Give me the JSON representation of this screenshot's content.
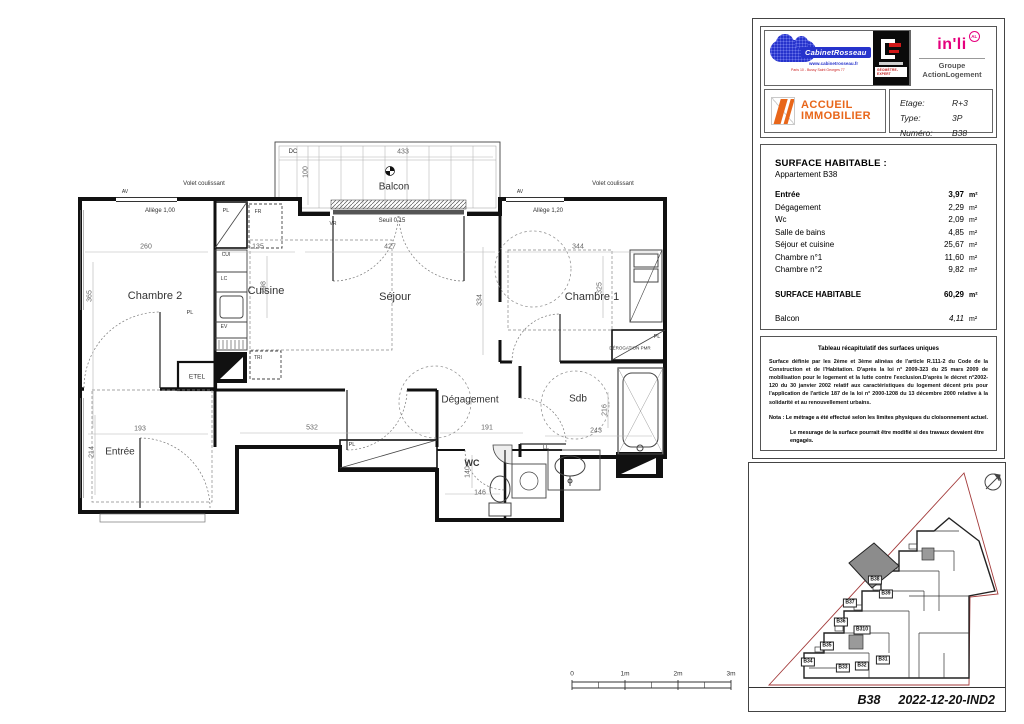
{
  "title_block": {
    "cabinet": {
      "name": "CabinetRosseau",
      "url": "www.cabinetrosseau.fr",
      "address": "Paris 10 - Bussy Saint Georges 77"
    },
    "geometre": {
      "label": "GÉOMÈTRE-EXPERT"
    },
    "inli": {
      "name": "in'li",
      "badge": "AL",
      "group": "Groupe ActionLogement"
    },
    "accueil": {
      "line1": "ACCUEIL",
      "line2": "IMMOBILIER"
    },
    "info": {
      "rows": [
        {
          "label": "Etage:",
          "value": "R+3"
        },
        {
          "label": "Type:",
          "value": "3P"
        },
        {
          "label": "Numéro:",
          "value": "B38"
        }
      ]
    }
  },
  "surface_table": {
    "title": "SURFACE HABITABLE :",
    "subtitle": "Appartement B38",
    "rows": [
      {
        "label": "Entrée",
        "value": "3,97",
        "unit": "m²"
      },
      {
        "label": "Dégagement",
        "value": "2,29",
        "unit": "m²"
      },
      {
        "label": "Wc",
        "value": "2,09",
        "unit": "m²"
      },
      {
        "label": "Salle de bains",
        "value": "4,85",
        "unit": "m²"
      },
      {
        "label": "Séjour et cuisine",
        "value": "25,67",
        "unit": "m²"
      },
      {
        "label": "Chambre n°1",
        "value": "11,60",
        "unit": "m²"
      },
      {
        "label": "Chambre n°2",
        "value": "9,82",
        "unit": "m²"
      }
    ],
    "total": {
      "label": "SURFACE HABITABLE",
      "value": "60,29",
      "unit": "m²"
    },
    "balcon": {
      "label": "Balcon",
      "value": "4,11",
      "unit": "m²"
    }
  },
  "notes": {
    "title": "Tableau récapitulatif des surfaces uniques",
    "p1": "Surface définie par les 2ème et 3ème alinéas de l'article R.111-2 du Code de la Construction et de l'Habitation. D'après la loi n° 2009-323 du 25 mars 2009 de mobilisation pour le logement et la lutte contre l'exclusion.D'après le décret n°2002-120 du 30 janvier 2002 relatif aux caractéristiques du logement décent pris pour l'application de l'article 187 de la loi n° 2000-1208 du 13 décembre 2000 relative à la solidarité et au renouvellement urbains.",
    "nota1": "Nota : Le métrage a été effectué selon les limites physiques du cloisonnement actuel.",
    "nota2": "Le mesurage de la surface pourrait être modifié si des travaux devaient être engagés."
  },
  "site_plan": {
    "units": [
      "B38",
      "B39",
      "B37",
      "B36",
      "B310",
      "B35",
      "B34",
      "B33",
      "B32",
      "B31"
    ],
    "footer_ref": "B38",
    "footer_date": "2022-12-20-IND2",
    "highlight_color": "#8c8c8c",
    "boundary_color": "#a33a3a"
  },
  "floor_plan": {
    "rooms": {
      "balcon": "Balcon",
      "chambre2": "Chambre 2",
      "cuisine": "Cuisine",
      "sejour": "Séjour",
      "chambre1": "Chambre 1",
      "entree": "Entrée",
      "degagement": "Dégagement",
      "sdb": "Sdb",
      "wc": "WC"
    },
    "ann": {
      "volet": "Volet coulissant",
      "av": "AV",
      "allege100": "Allège 1,00",
      "allege120": "Allège 1,20",
      "seuil": "Seuil 0,15",
      "dc": "DC",
      "vr": "VR",
      "pl": "PL",
      "fr": "FR",
      "cui": "CUI",
      "lc": "LC",
      "ev": "EV",
      "tri": "TRI",
      "etel": "ETEL",
      "ll": "LL",
      "derogation": "DÉROGATION PMR"
    },
    "dims": {
      "d433": "433",
      "d100": "100",
      "d260": "260",
      "d135": "135",
      "d427": "427",
      "d344": "344",
      "d365": "365",
      "d298": "298",
      "d334": "334",
      "d325": "325",
      "d532": "532",
      "d191": "191",
      "d243": "243",
      "d216": "216",
      "d140": "140",
      "d146": "146",
      "d193": "193",
      "d214": "214"
    }
  },
  "scale_bar": {
    "labels": [
      "0",
      "1m",
      "2m",
      "3m"
    ]
  }
}
